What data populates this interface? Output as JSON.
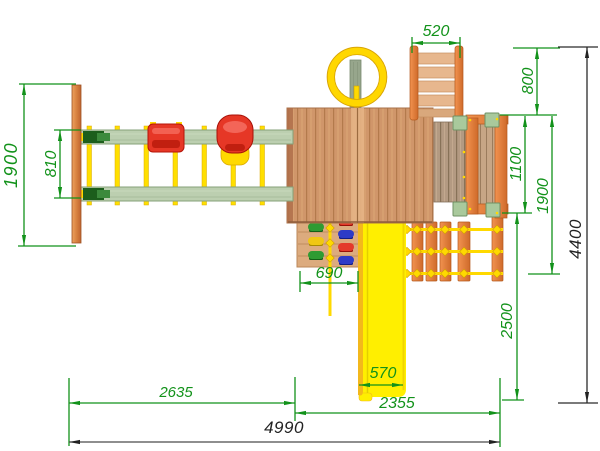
{
  "dims": {
    "frame_span_left": "1900",
    "beam_spacing": "810",
    "ladder_width": "520",
    "ladder_offset": "800",
    "balcony_depth": "1100",
    "right_section_depth": "1900",
    "slide_run_depth": "2500",
    "overall_depth": "4400",
    "climb_wall_width": "690",
    "slide_width": "570",
    "swing_section_width": "2635",
    "tower_section_width": "2355",
    "overall_width": "4990"
  },
  "colors": {
    "dimension_green": "#12921a",
    "dimension_dark": "#2b2b2b",
    "wood_orange": "#e0813b",
    "roof_wood": "#d0966a",
    "beam_sage": "#bccfb0",
    "slide_yellow": "#ffef00",
    "rope_yellow": "#ffd900",
    "seat_red": "#e63726"
  }
}
